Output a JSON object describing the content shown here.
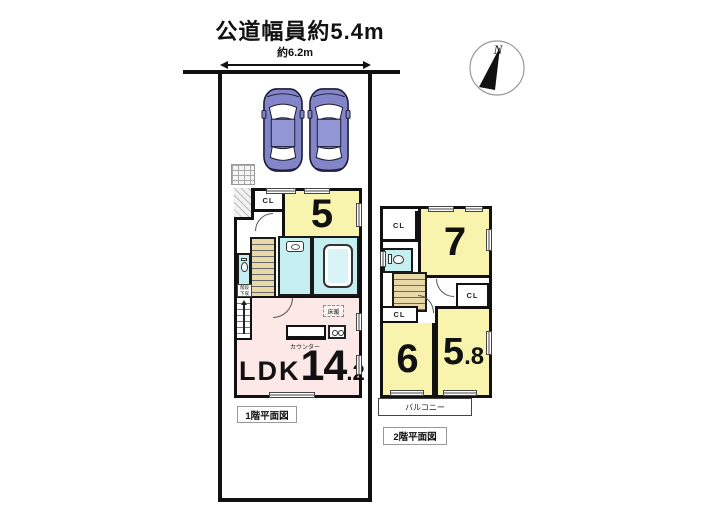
{
  "header": {
    "title": "公道幅員約5.4m",
    "width_label": "約6.2m",
    "compass_n": "N"
  },
  "labels": {
    "cl": "CL",
    "counter": "カウンター",
    "floor_heating": "床暖",
    "understair_storage": "階段下収納",
    "balcony": "バルコニー",
    "floor1_caption": "1階平面図",
    "floor2_caption": "2階平面図"
  },
  "floor1": {
    "room5": "5",
    "ldk_name": "LDK",
    "ldk_size_int": "14",
    "ldk_size_dec": ".2"
  },
  "floor2": {
    "room7": "7",
    "room6": "6",
    "room58_int": "5",
    "room58_dec": ".8"
  },
  "colors": {
    "room_yellow": "#f8f4ae",
    "ldk_pink": "#fce8e6",
    "wet_cyan": "#c6eff2",
    "stair_tan": "#ead9a8",
    "car_body": "#8286c8",
    "wall": "#111111"
  }
}
